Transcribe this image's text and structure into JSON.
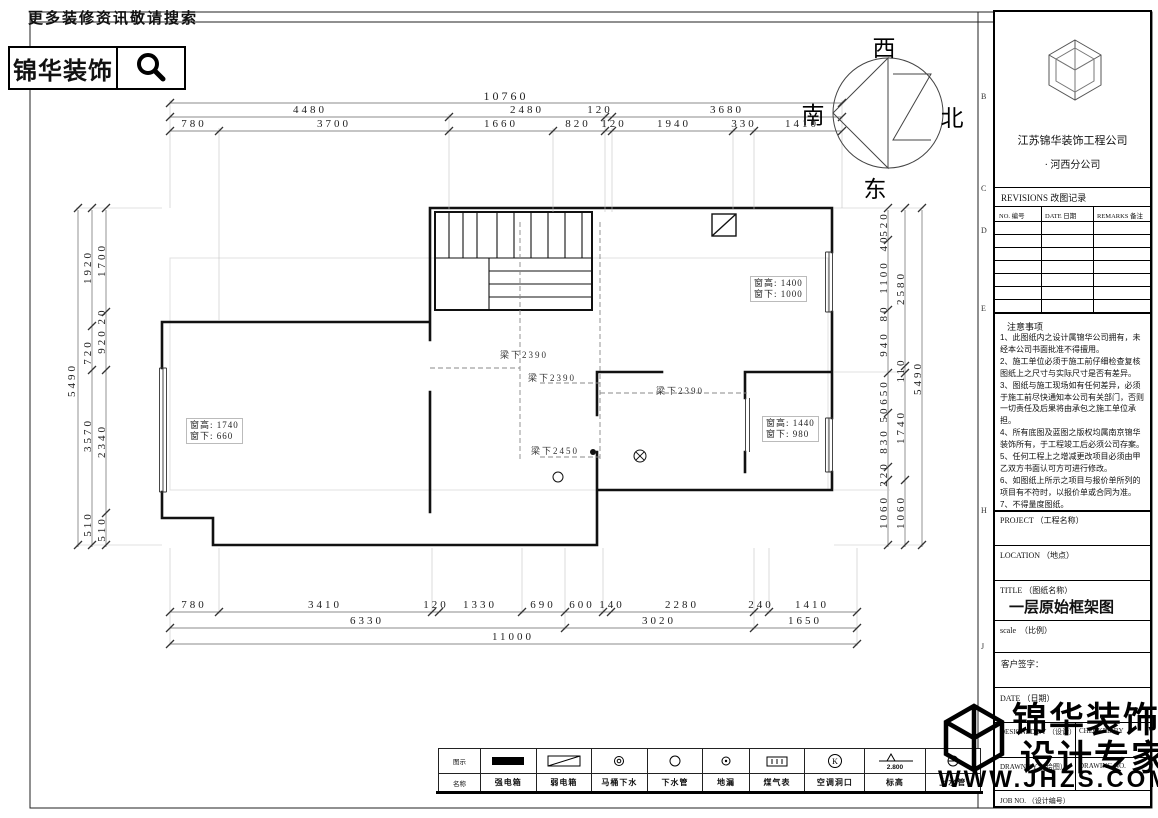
{
  "header": {
    "search_hint": "更多装修资讯敬请搜索",
    "brand": "锦华装饰"
  },
  "compass": {
    "west": "西",
    "south": "南",
    "north": "北",
    "east": "东"
  },
  "plan": {
    "windows": [
      {
        "height": "窗高: 1400",
        "sill": "窗下: 1000"
      },
      {
        "height": "窗高: 1740",
        "sill": "窗下: 660"
      },
      {
        "height": "窗高: 1440",
        "sill": "窗下: 980"
      }
    ],
    "beams": [
      "梁下2390",
      "梁下2390",
      "梁下2390",
      "梁下2450"
    ]
  },
  "dims": {
    "top1": [
      "10760"
    ],
    "top2": [
      "4480",
      "2480",
      "120",
      "3680"
    ],
    "top3": [
      "780",
      "3700",
      "1660",
      "820",
      "120",
      "1940",
      "330",
      "1410"
    ],
    "bottom1": [
      "780",
      "3410",
      "120",
      "1330",
      "690",
      "600",
      "140",
      "2280",
      "240",
      "1410"
    ],
    "bottom2": [
      "6330",
      "3020",
      "1650"
    ],
    "bottom3": [
      "11000"
    ],
    "left_outer": [
      "5490"
    ],
    "left_mid": [
      "1920",
      "720",
      "3570",
      "510"
    ],
    "left_inner": [
      "1700",
      "20",
      "920",
      "2340",
      "510"
    ],
    "right_inner": [
      "520",
      "40",
      "1100",
      "80",
      "940",
      "650",
      "50",
      "830",
      "220",
      "1060"
    ],
    "right_mid": [
      "2580",
      "110",
      "1740",
      "1060"
    ],
    "right_outer": [
      "5490"
    ]
  },
  "legend": {
    "col_headers": [
      "图示",
      "名称"
    ],
    "items": [
      {
        "name": "强电箱"
      },
      {
        "name": "弱电箱"
      },
      {
        "name": "马桶下水"
      },
      {
        "name": "下水管"
      },
      {
        "name": "地漏"
      },
      {
        "name": "煤气表"
      },
      {
        "name": "空调洞口"
      },
      {
        "name": "标高",
        "value": "2.800"
      },
      {
        "name": "上水管"
      }
    ]
  },
  "titleblock": {
    "company_line1": "江苏锦华装饰工程公司",
    "company_line2": "· 河西分公司",
    "revisions_title": "REVISIONS 改图记录",
    "rev_headers": [
      "NO. 编号",
      "DATE 日期",
      "REMARKS 备注"
    ],
    "notes_title": "注意事项",
    "notes": [
      "1、此图纸内之设计属锦华公司拥有，未经本公司书面批准不得擅用。",
      "2、施工单位必须于施工前仔细检查复核图纸上之尺寸与实际尺寸是否有差异。",
      "3、图纸与施工现场如有任何差异，必须于施工前尽快通知本公司有关部门，否则一切责任及后果将由承包之施工单位承担。",
      "4、所有底图及蓝图之版权均属南京锦华装饰所有，于工程竣工后必须公司存案。",
      "5、任何工程上之增减更改项目必须由甲乙双方书面认可方可进行修改。",
      "6、如图纸上所示之项目与报价单所列的项目有不符时，以报价单或合同为准。",
      "7、不得量度图纸。"
    ],
    "project_label": "PROJECT （工程名称）",
    "location_label": "LOCATION （地点）",
    "title_label": "TITLE （图纸名称）",
    "title_value": "一层原始框架图",
    "scale_label": "scale　（比例）",
    "sign_label": "客户签字：",
    "date_label": "DATE （日期）",
    "designed_label": "DESIGNED BY （设计）",
    "checked_label": "CHECKED BY",
    "drawn_label": "DRAWN BY （绘图）",
    "drawing_no_label": "DRAWING NO.",
    "job_label": "JOB NO. （设计编号）",
    "zones": [
      "B",
      "C",
      "D",
      "E",
      "H",
      "J"
    ]
  },
  "watermark": {
    "brand_top": "锦华装饰",
    "brand_bottom": "设计专家",
    "url": "WWW.JHZS.COM"
  }
}
